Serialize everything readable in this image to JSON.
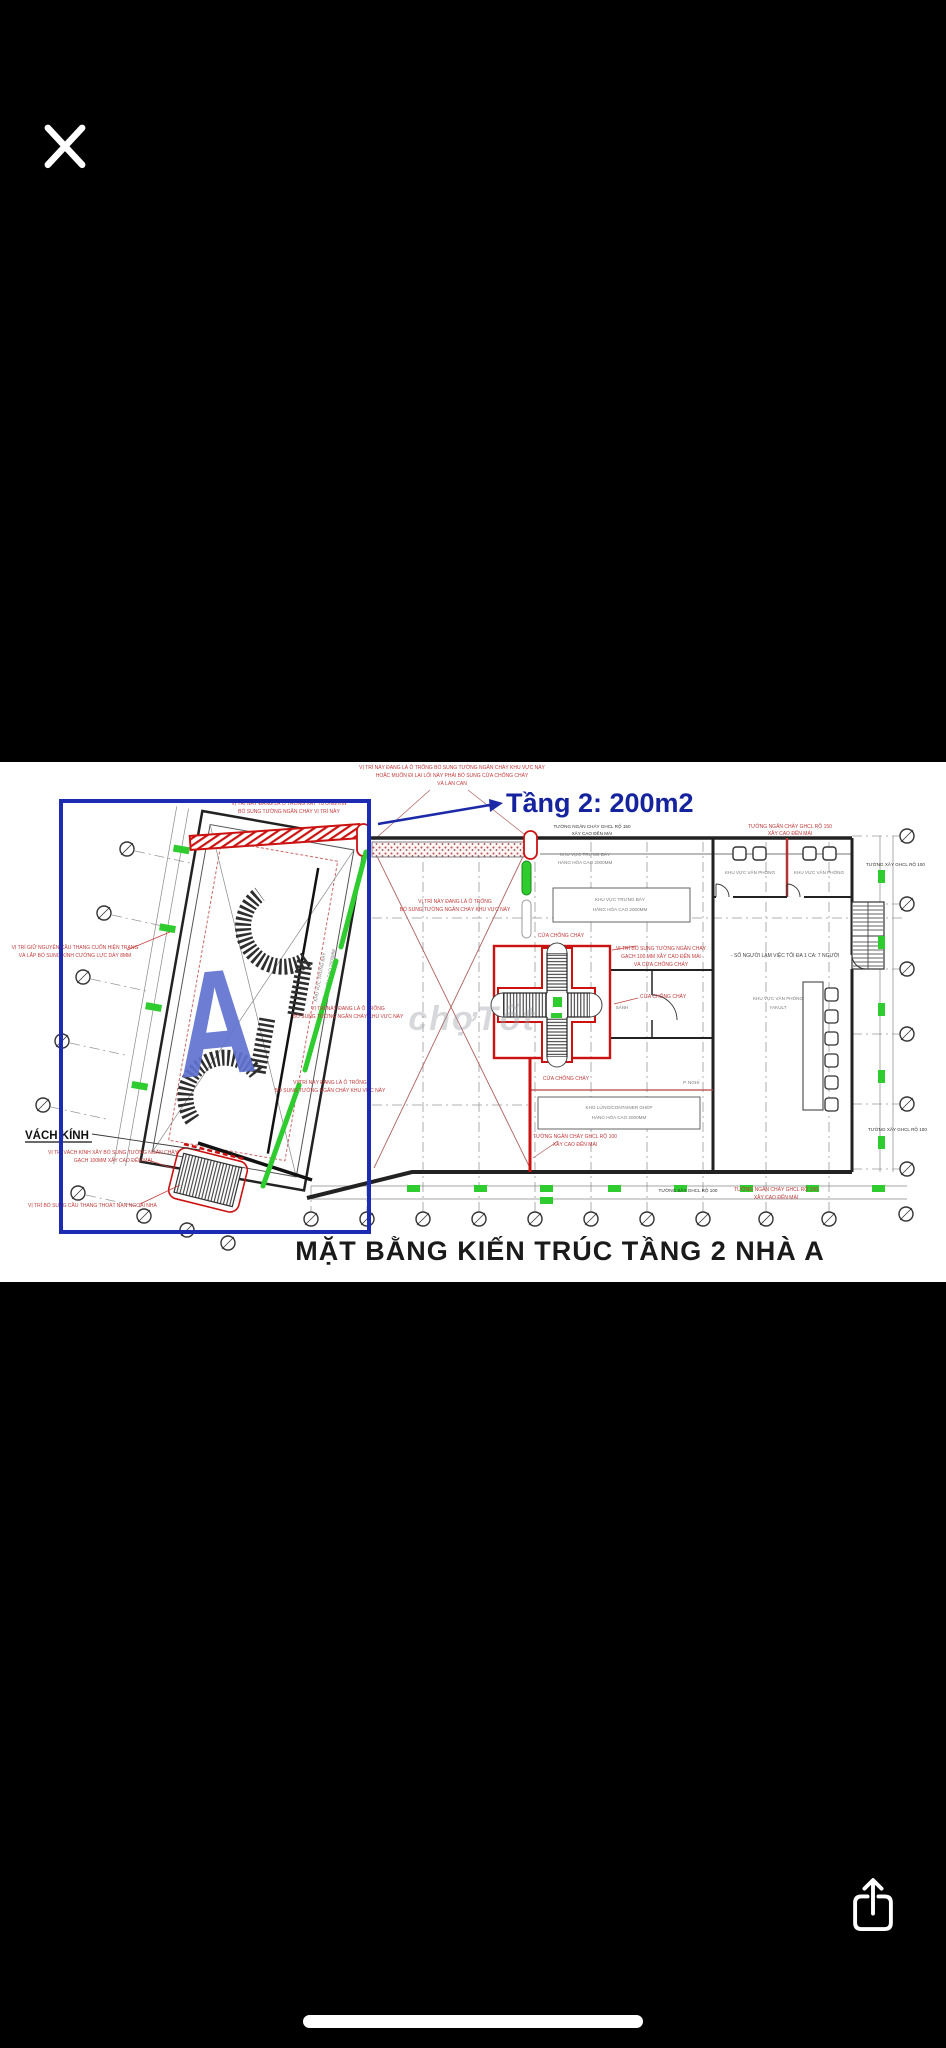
{
  "plan": {
    "title": "MẶT BẰNG KIẾN TRÚC TẦNG 2 NHÀ A",
    "area_note": "Tầng 2: 200m2",
    "watermark": "chợTốt",
    "wing_label": "A",
    "labels": {
      "vach_kinh": "VÁCH KÍNH",
      "sanh": "SẢNH",
      "p_nghi": "P. NGHỈ",
      "office": "KHU VỰC VĂN PHÒNG",
      "yakult_l2": "YAKULT",
      "display_l1": "KHU VỰC TRƯNG BÀY",
      "display_l2": "HÀNG HÓA CAO 2000MM",
      "storage_l1": "KHO LỬNG/CONTAINER GHÉP",
      "storage_l2": "HÀNG HÓA CAO 2000MM",
      "staff": "- SỐ NGƯỜI LÀM VIỆC TỐI ĐA 1 CA: 7 NGƯỜI",
      "fw150_l1": "TƯỜNG NGĂN CHÁY GHCL RỘ 150",
      "fw150_l2": "XÂY CAO ĐẾN MÁI",
      "fw100_l1": "TƯỜNG NGĂN CHÁY GHCL RỘ 100",
      "fw100_l2": "XÂY CAO ĐẾN MÁI",
      "wall100": "TƯỜNG XÂY GHCL RỘ 100",
      "fire_door": "CỬA CHỐNG CHÁY"
    },
    "notes": {
      "top_l1": "VỊ TRÍ NÀY ĐANG LÀ Ô TRỐNG BỔ SUNG TƯỜNG NGĂN CHÁY KHU VỰC NÀY",
      "top_l2": "HOẶC MUỐN ĐI LẠI LỐI NÀY PHẢI BỔ SUNG CỬA CHỐNG CHÁY",
      "top_l3": "VÀ LAN CAN",
      "blue_l1": "VỊ TRÍ NÀY ĐANG LÀ Ô TRỐNG XÂY TƯỜNG KÍN",
      "blue_l2": "BỔ SUNG TƯỜNG NGĂN CHÁY VỊ TRÍ NÀY",
      "keep_l1": "VỊ TRÍ GIỮ NGUYÊN CẦU THANG CUỐN HIỆN TRẠNG",
      "keep_l2": "VÀ LẮP BỔ SUNG KÍNH CƯỜNG LỰC DÀY 8MM",
      "void_l1": "VỊ TRÍ NÀY ĐANG LÀ Ô TRỐNG",
      "void_l2": "BỔ SUNG TƯỜNG NGĂN CHÁY KHU VỰC NÀY",
      "cross_l1": "VỊ TRÍ BỔ SUNG TƯỜNG NGĂN CHÁY",
      "cross_l2": "GẠCH 100 MM XÂY CAO ĐẾN MÁI",
      "cross_l3": "VÀ CỬA CHỐNG CHÁY",
      "glass_l1": "VỊ TRÍ VÁCH KÍNH XÂY BỔ SUNG TƯỜNG NGĂN CHÁY",
      "glass_l2": "GẠCH 100MM XÂY CAO ĐẾN MÁI",
      "escape": "VỊ TRÍ BỔ SUNG CẦU THANG THOÁT NẠN NGOÀI NHÀ"
    },
    "colors": {
      "background": "#000000",
      "highlight_blue": "#1d2bb2",
      "annotation_blue": "#16239e",
      "fire_red": "#cc1111",
      "glass_green": "#2ecc2e",
      "note_red": "#c23a3a"
    }
  }
}
